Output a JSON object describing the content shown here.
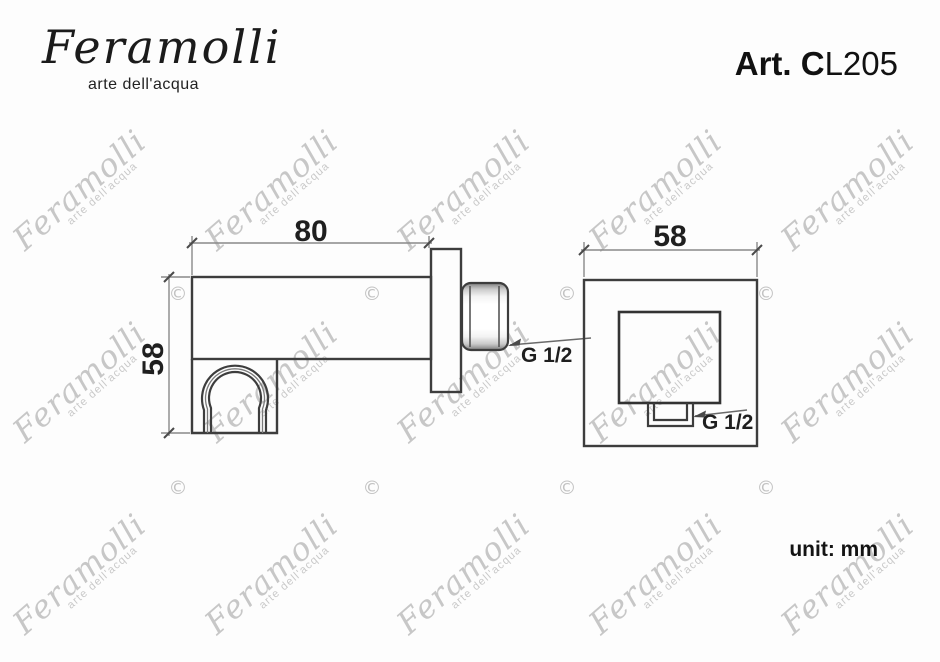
{
  "header": {
    "logo_script": "Feramolli",
    "logo_tagline": "arte dell'acqua",
    "article_prefix": "Art. C",
    "article_suffix": "L205"
  },
  "views": {
    "side": {
      "length_dim": "80",
      "height_dim": "58",
      "thread_label": "G 1/2"
    },
    "front": {
      "width_dim": "58",
      "thread_label": "G 1/2"
    }
  },
  "footer": {
    "unit_label": "unit: mm"
  },
  "watermark": {
    "script": "Feramolli",
    "tagline": "arte dell'acqua",
    "copyright_symbol": "©",
    "script_color": "#c7c7c7",
    "copyright_color": "#c2c2c2",
    "script_positions": [
      [
        82,
        193
      ],
      [
        274,
        193
      ],
      [
        466,
        193
      ],
      [
        658,
        193
      ],
      [
        850,
        193
      ],
      [
        82,
        385
      ],
      [
        274,
        385
      ],
      [
        466,
        385
      ],
      [
        658,
        385
      ],
      [
        850,
        385
      ],
      [
        82,
        577
      ],
      [
        274,
        577
      ],
      [
        466,
        577
      ],
      [
        658,
        577
      ],
      [
        850,
        577
      ]
    ],
    "copyright_positions": [
      [
        178,
        294
      ],
      [
        372,
        294
      ],
      [
        567,
        294
      ],
      [
        766,
        294
      ],
      [
        178,
        488
      ],
      [
        372,
        488
      ],
      [
        567,
        488
      ],
      [
        766,
        488
      ]
    ]
  },
  "colors": {
    "outline": "#3d3d3d",
    "dim_line": "#8a8a8a",
    "tick": "#4a4a4a",
    "text": "#1f1f1f",
    "watermark": "#c7c7c7",
    "background": "#fdfdfd"
  }
}
